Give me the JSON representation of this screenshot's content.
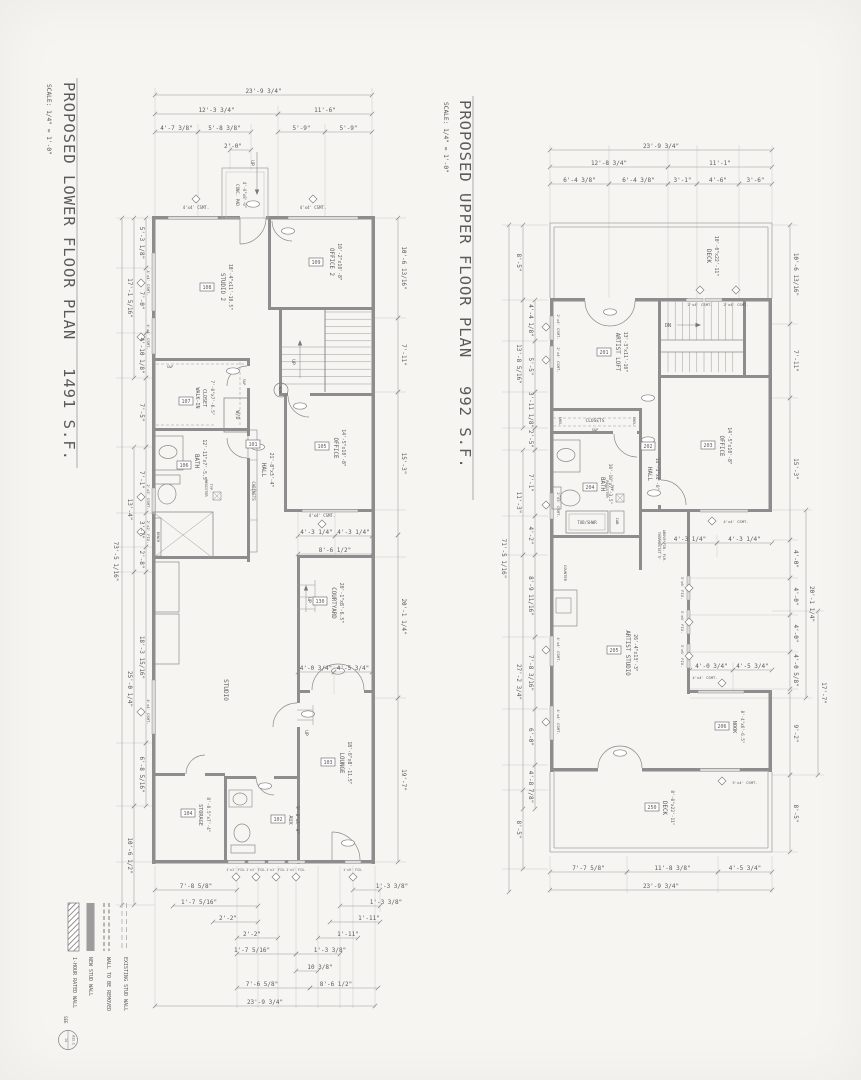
{
  "lp": {
    "title": "PROPOSED LOWER FLOOR PLAN",
    "area": "1491 S.F.",
    "scale": "SCALE: 1/4\" = 1'-0\"",
    "rooms": {
      "studio2": {
        "n": "STUDIO 2",
        "s": "18'-4\"x11'-10.5\"",
        "t": "108"
      },
      "office2": {
        "n": "OFFICE 2",
        "s": "10'-2\"x10'-8\"",
        "t": "109"
      },
      "walkin": {
        "n1": "WALK-IN",
        "n2": "CLOSET",
        "s": "7'-0\"x7'-6.5\"",
        "t": "107"
      },
      "bath": {
        "n": "BATH",
        "s": "12'-11\"x7'-5.5\"",
        "t": "106"
      },
      "hall": {
        "n": "HALL",
        "s": "21'-8\"x3'-4\"",
        "t": "101"
      },
      "office": {
        "n": "OFFICE",
        "s": "14'-5\"x10'-8\"",
        "t": "105"
      },
      "courtyard": {
        "n": "COURTYARD",
        "s": "20'-1\"x8'-6.5\"",
        "t": "130"
      },
      "studio": {
        "n": "STUDIO"
      },
      "lounge": {
        "n": "LOUNGE",
        "s": "18'-6\"x8'-11.5\"",
        "t": "103"
      },
      "storage": {
        "n": "STORAGE",
        "s": "8'-8.5\"x7'-4\"",
        "t": "104"
      },
      "aux": {
        "n": "AUX",
        "s": "9'-8\"x5'-8\"",
        "t": "102"
      }
    },
    "n": {
      "up": "UP",
      "wd": "W/D",
      "wh": "W/H",
      "cab": "CABINETS",
      "reg": "REGISTER",
      "reg2": "TYP.",
      "bench": "BENCH",
      "sp": "S&P",
      "conc1": "CONC. PAD",
      "conc2": "4'-0\"x8'-0\""
    },
    "w": {
      "w44": "4'x4' CSMT.",
      "w23": "2'x3' CSMT.",
      "w22": "2'x2' FIX.",
      "w11": "1'x1' FIX.",
      "w15": "1'x5' FIX."
    },
    "d": {
      "t_all": "23'-9 3/4\"",
      "t_a": "12'-3 3/4\"",
      "t_b": "11'-6\"",
      "t_c": "4'-7 3/8\"",
      "t_d": "5'-8 3/8\"",
      "t_e": "5'-9\"",
      "t_f": "5'-9\"",
      "t_g": "2'-0\"",
      "l_all": "73'-5 1/16\"",
      "l_g1": "17'-1 5/16\"",
      "l_g1a": "5'-3 1/8\"",
      "l_g1b": "7'-0\"",
      "l_g1c": "4'-10 1/8\"",
      "l_m": "7'-5\"",
      "l_g2": "13'-4\"",
      "l_g2a": "7'-1\"",
      "l_g2b": "3'-7\"",
      "l_g2c": "2'-8\"",
      "l_g3": "25'-0 1/4\"",
      "l_g3a": "18'-3 15/16\"",
      "l_g3b": "6'-8 5/16\"",
      "l_g4": "10'-6 1/2\"",
      "r_a": "10'-6 13/16\"",
      "r_b": "7'-11\"",
      "r_c": "15'-3\"",
      "r_d": "20'-1 1/4\"",
      "r_e": "19'-7\"",
      "m_a": "4'-3 1/4\"",
      "m_b": "4'-3 1/4\"",
      "m_c": "8'-6 1/2\"",
      "m_d": "4'-0 3/4\"",
      "m_e": "4'-5 3/4\"",
      "b_r1a": "7'-8 5/8\"",
      "b_r1b": "1'-3 3/8\"",
      "b_r2a": "1'-7 5/16\"",
      "b_r2b": "1'-3 3/8\"",
      "b_r3a": "2'-2\"",
      "b_r3b": "1'-11\"",
      "b_r4a": "2'-2\"",
      "b_r4b": "1'-11\"",
      "b_r5a": "1'-7 5/16\"",
      "b_r5b": "1'-3 3/8\"",
      "b_r6": "10 3/8\"",
      "b_r7a": "7'-6 5/8\"",
      "b_r7b": "8'-6 1/2\"",
      "b_all": "23'-9 3/4\""
    }
  },
  "up": {
    "title": "PROPOSED UPPER FLOOR PLAN",
    "area": "992 S.F.",
    "scale": "SCALE: 1/4\" = 1'-0\"",
    "rooms": {
      "deck_top": {
        "n": "DECK",
        "s": "10'-0\"x22'-11\""
      },
      "loft": {
        "n": "ARTIST LOFT",
        "s": "13'-3\"x11'-10\"",
        "t": "201"
      },
      "office": {
        "n": "OFFICE",
        "s": "14'-5\"x10'-8\"",
        "t": "203"
      },
      "bath": {
        "n": "BATH",
        "s": "10'-10\"x7'-3.5\"",
        "t": "204"
      },
      "hall": {
        "n": "HALL",
        "s": "14'-1\"x4'-0\"",
        "t": "202"
      },
      "studio": {
        "n": "ARTIST STUDIO",
        "s": "26'-4\"x13'-3\"",
        "t": "205"
      },
      "nook": {
        "n": "NOOK",
        "s": "8'-4\"x6'-6.5\"",
        "t": "206"
      },
      "deck_bottom": {
        "n": "DECK",
        "s": "8'-0\"x22'-11\"",
        "t": "250"
      },
      "closets": {
        "n": "CLOSETS"
      }
    },
    "n": {
      "dn": "DN",
      "tub": "TUB/SHWR",
      "cab": "CAB",
      "shel": "SHEL",
      "sp": "S&P",
      "counter": "COUNTER",
      "reg": "REGISTER",
      "reg2": "TYP.",
      "therm1": "THERMOSTAT 5'",
      "therm2": "ABOVE FIN. FLR."
    },
    "w": {
      "w24": "2'x4' CSMT.",
      "w23": "2'x3' CSMT.",
      "w44": "4'x4' CSMT.",
      "w36": "3'x6' FIX.",
      "w54": "5'x4' CSMT."
    },
    "d": {
      "t_all": "23'-9 3/4\"",
      "t_a": "12'-8 3/4\"",
      "t_b": "11'-1\"",
      "t_c": "6'-4 3/8\"",
      "t_d": "6'-4 3/8\"",
      "t_e": "3'-1\"",
      "t_f": "4'-6\"",
      "t_g": "3'-6\"",
      "l_all": "71'-5 1/16\"",
      "l_a": "8'-5\"",
      "l_g1": "13'-8 5/16\"",
      "l_g1a": "4'-4 1/8\"",
      "l_g1b": "5'-5\"",
      "l_g1c": "3'-11 1/8\"",
      "l_b": "2'-5\"",
      "l_g2": "11'-3\"",
      "l_g2a": "7'-1\"",
      "l_g2b": "4'-2\"",
      "l_g3": "27'-2 3/4\"",
      "l_g3a": "8'-9 11/16\"",
      "l_g3b": "7'-8 3/16\"",
      "l_g3c": "6'-0\"",
      "l_g3d": "4'-8 7/8\"",
      "l_c": "8'-5\"",
      "r_a": "10'-6 13/16\"",
      "r_b": "7'-11\"",
      "r_c": "15'-3\"",
      "r_d": "4'-0\"",
      "r_e": "4'-0\"",
      "r_f": "4'-0\"",
      "r_g": "4'-0 5/8\"",
      "r_h": "20'-1 1/4\"",
      "r_i": "9'-2\"",
      "r_j": "17'-7\"",
      "r_k": "8'-5\"",
      "m_a": "4'-3 1/4\"",
      "m_b": "4'-3 1/4\"",
      "m_c": "4'-0 3/4\"",
      "m_d": "4'-5 3/4\"",
      "b_a": "7'-7 5/8\"",
      "b_b": "11'-8 3/8\"",
      "b_c": "4'-5 3/4\"",
      "b_all": "23'-9 3/4\""
    }
  },
  "legend": {
    "i1": "1-HOUR RATED WALL",
    "see": "SEE",
    "i2": "NEW STUD WALL",
    "i3": "WALL TO BE REMOVED",
    "i4": "EXISTING STUD WALL",
    "d_top": "14",
    "d_bot": "A13.1"
  }
}
